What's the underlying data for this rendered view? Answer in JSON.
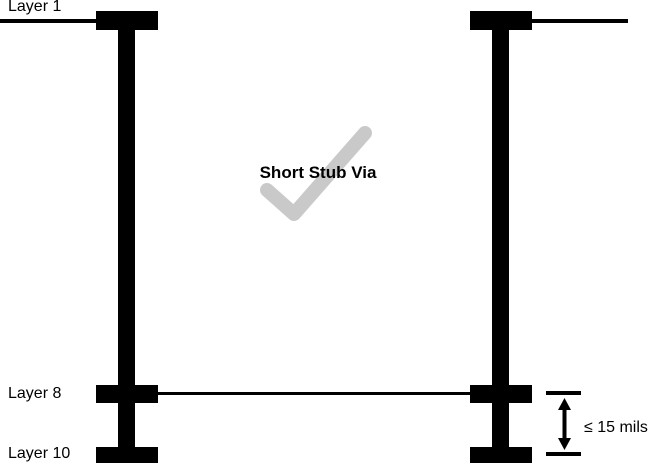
{
  "diagram": {
    "labels": {
      "layer1": "Layer 1",
      "layer8": "Layer 8",
      "layer10": "Layer 10"
    },
    "center_label": "Short Stub Via",
    "dimension_label": "≤ 15 mils",
    "colors": {
      "ink": "#000000",
      "checkmark": "#c9c9c9",
      "background": "#ffffff"
    }
  }
}
